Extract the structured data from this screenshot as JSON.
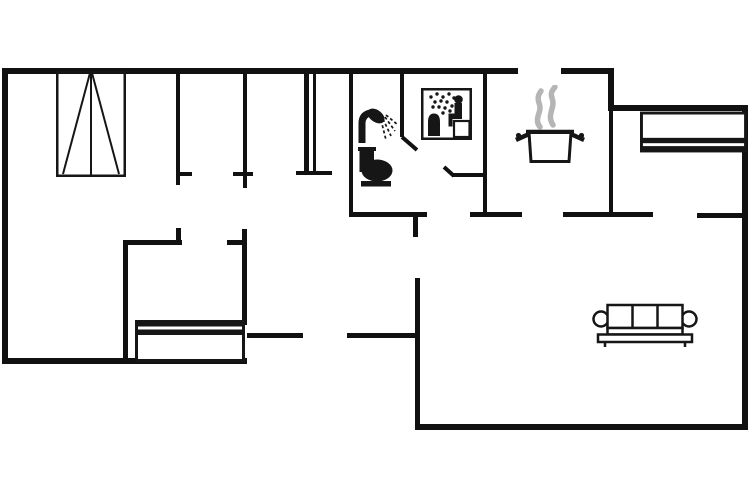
{
  "canvas": {
    "width": 754,
    "height": 498
  },
  "colors": {
    "wall": "#111111",
    "furniture_line": "#161616",
    "steam": "#b5b5b5",
    "background": "#ffffff"
  },
  "floorplan": {
    "walls": [
      {
        "name": "wall-exterior-top-left",
        "x": 2,
        "y": 68,
        "w": 516,
        "h": 6
      },
      {
        "name": "wall-exterior-top-kitchen",
        "x": 561,
        "y": 68,
        "w": 53,
        "h": 6
      },
      {
        "name": "wall-exterior-step",
        "x": 608,
        "y": 68,
        "w": 6,
        "h": 43
      },
      {
        "name": "wall-exterior-top-right",
        "x": 608,
        "y": 105,
        "w": 140,
        "h": 6
      },
      {
        "name": "wall-exterior-right",
        "x": 742,
        "y": 105,
        "w": 6,
        "h": 325
      },
      {
        "name": "wall-exterior-bottom-living",
        "x": 415,
        "y": 424,
        "w": 333,
        "h": 6
      },
      {
        "name": "wall-living-left",
        "x": 415,
        "y": 278,
        "w": 5,
        "h": 152
      },
      {
        "name": "wall-mid-horizontal-a",
        "x": 247,
        "y": 333,
        "w": 56,
        "h": 5
      },
      {
        "name": "wall-mid-horizontal-b",
        "x": 347,
        "y": 333,
        "w": 70,
        "h": 5
      },
      {
        "name": "wall-exterior-bottom-left",
        "x": 2,
        "y": 358,
        "w": 245,
        "h": 6
      },
      {
        "name": "wall-exterior-left",
        "x": 2,
        "y": 68,
        "w": 6,
        "h": 296
      },
      {
        "name": "wall-bedroom1-divider",
        "x": 176,
        "y": 73,
        "w": 4,
        "h": 112
      },
      {
        "name": "wall-bedroom1-door-tick",
        "x": 176,
        "y": 172,
        "w": 16,
        "h": 4
      },
      {
        "name": "wall-bedroom2-divider",
        "x": 243,
        "y": 73,
        "w": 4,
        "h": 115
      },
      {
        "name": "wall-bedroom2-door-tick",
        "x": 233,
        "y": 172,
        "w": 20,
        "h": 4
      },
      {
        "name": "wall-double-a",
        "x": 304,
        "y": 73,
        "w": 5,
        "h": 102
      },
      {
        "name": "wall-double-b",
        "x": 313,
        "y": 73,
        "w": 3,
        "h": 102
      },
      {
        "name": "wall-double-tick",
        "x": 296,
        "y": 171,
        "w": 36,
        "h": 4
      },
      {
        "name": "wall-bathroom-left",
        "x": 349,
        "y": 73,
        "w": 4,
        "h": 142
      },
      {
        "name": "wall-hallway-a",
        "x": 349,
        "y": 212,
        "w": 78,
        "h": 5
      },
      {
        "name": "wall-hallway-stub",
        "x": 413,
        "y": 217,
        "w": 5,
        "h": 20
      },
      {
        "name": "wall-hallway-b",
        "x": 470,
        "y": 212,
        "w": 52,
        "h": 5
      },
      {
        "name": "wall-hallway-c",
        "x": 563,
        "y": 212,
        "w": 90,
        "h": 5
      },
      {
        "name": "wall-hallway-d",
        "x": 697,
        "y": 213,
        "w": 50,
        "h": 5
      },
      {
        "name": "wall-sauna-left",
        "x": 400,
        "y": 73,
        "w": 4,
        "h": 64
      },
      {
        "name": "wall-sauna-door-ledge",
        "x": 452,
        "y": 173,
        "w": 31,
        "h": 4
      },
      {
        "name": "wall-sauna-right",
        "x": 483,
        "y": 73,
        "w": 4,
        "h": 144
      },
      {
        "name": "wall-kitchen-right",
        "x": 609,
        "y": 73,
        "w": 4,
        "h": 140
      },
      {
        "name": "wall-smallroom-top",
        "x": 123,
        "y": 240,
        "w": 59,
        "h": 5
      },
      {
        "name": "wall-smallroom-stub",
        "x": 176,
        "y": 228,
        "w": 5,
        "h": 14
      },
      {
        "name": "wall-smallroom-left",
        "x": 123,
        "y": 240,
        "w": 5,
        "h": 121
      },
      {
        "name": "wall-smallroom-right",
        "x": 242,
        "y": 229,
        "w": 5,
        "h": 96
      },
      {
        "name": "wall-smallroom-door-tick",
        "x": 227,
        "y": 240,
        "w": 20,
        "h": 5
      }
    ],
    "diagonal_walls": [
      {
        "name": "door-swing-sauna-inner",
        "x1": 402,
        "y1": 137,
        "x2": 417,
        "y2": 150,
        "stroke": 4
      },
      {
        "name": "door-swing-sauna-outer",
        "x1": 444,
        "y1": 167,
        "x2": 454,
        "y2": 176,
        "stroke": 4
      }
    ],
    "furniture": [
      {
        "name": "wardrobe-icon",
        "symbol": "wardrobe",
        "x": 56,
        "y": 71,
        "w": 70,
        "h": 106
      },
      {
        "name": "bed-left-icon",
        "symbol": "bed",
        "x": 135,
        "y": 320,
        "w": 110,
        "h": 42,
        "rotate": 180
      },
      {
        "name": "bed-right-icon",
        "symbol": "bed",
        "x": 640,
        "y": 111,
        "w": 107,
        "h": 42
      },
      {
        "name": "shower-icon",
        "symbol": "shower",
        "x": 356,
        "y": 106,
        "w": 43,
        "h": 38
      },
      {
        "name": "toilet-icon",
        "symbol": "toilet",
        "x": 357,
        "y": 147,
        "w": 38,
        "h": 40
      },
      {
        "name": "sauna-sign-icon",
        "symbol": "sauna",
        "x": 421,
        "y": 88,
        "w": 51,
        "h": 52
      },
      {
        "name": "cooking-pot-icon",
        "symbol": "pot",
        "x": 515,
        "y": 85,
        "w": 70,
        "h": 80
      },
      {
        "name": "sofa-icon",
        "symbol": "sofa",
        "x": 592,
        "y": 302,
        "w": 106,
        "h": 45
      }
    ]
  }
}
